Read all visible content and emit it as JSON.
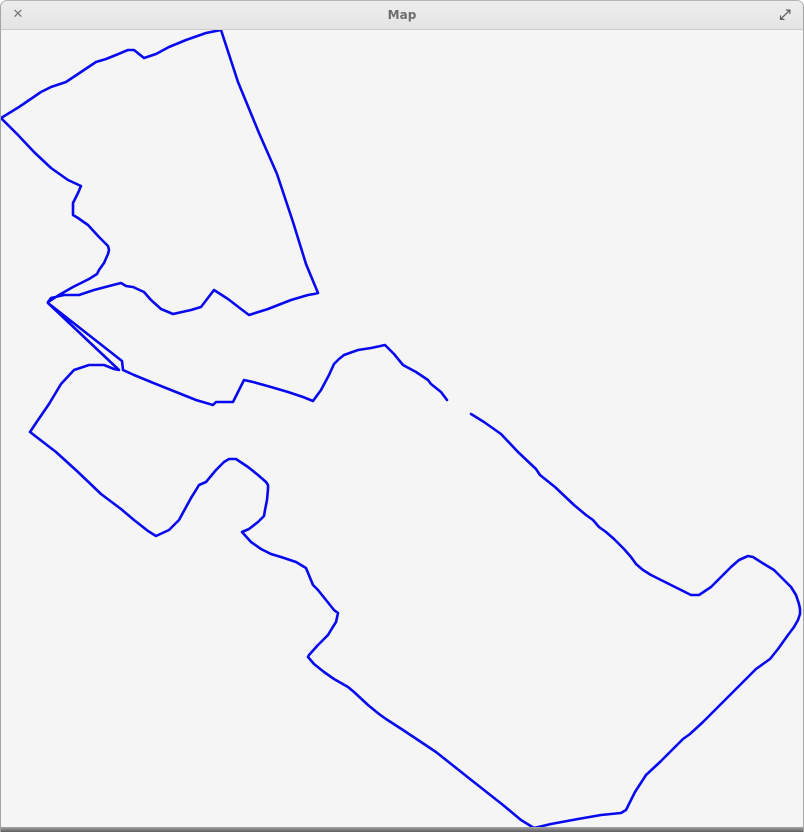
{
  "window": {
    "title": "Map",
    "close_icon": "✕",
    "expand_icon": "⤢"
  },
  "colors": {
    "titlebar_bg": "#e9e9e9",
    "titlebar_border": "#cdcdcd",
    "title_text": "#6d6d6d",
    "window_border": "#a5a5a5",
    "canvas_bg": "#f5f5f5",
    "bottom_bar": "#5e5e5e",
    "trace": "#0909ee"
  },
  "map": {
    "viewbox": "0 28 804 799",
    "stroke_color": "#0909ee",
    "stroke_width": 2.6,
    "paths": [
      {
        "name": "upper-boundary-trace",
        "closed": true,
        "points": "220,28 237,80 258,131 276,172 292,220 305,262 317,291 313,292 307,293 290,298 267,307 248,313 240,307 227,297 213,288 200,305 190,308 172,312 160,307 150,298 143,290 132,285 125,284 120,281 112,283 93,288 78,293 63,293 50,296 47,300 58,293 72,285 88,277 96,272 98,268 103,261 107,252 108,248 107,244 98,235 87,223 77,216 72,213 72,201 77,191 80,184 67,178 50,166 33,150 17,133 0,116 18,105 40,90 50,85 65,80 83,68 95,60 105,57 115,53 127,48 133,48 143,56 155,52 168,45 185,38 205,31"
      },
      {
        "name": "lower-loop-trace",
        "closed": false,
        "points": "470,412 483,420 500,432 517,450 535,467 539,473 554,485 573,503 585,513 592,518 598,525 605,530 613,537 618,542 623,547 630,555 635,562 642,568 650,573 660,578 670,583 680,588 690,593 698,593 710,585 720,575 730,565 738,558 747,554 752,555 763,562 773,568 782,577 790,585 795,593 798,602 799,607 799,612 797,618 793,625 787,633 777,647 769,657 755,667 745,677 735,687 722,700 712,710 702,720 689,732 682,737 672,747 659,760 645,773 634,790 625,808 620,811 600,813 577,817 550,822 533,826 520,818 502,803 469,777 435,750 402,728 385,717 378,712 367,703 353,690 347,685 333,677 323,670 313,662 307,655 308,653 317,643 322,638 327,633 330,628 335,620 337,611 333,608 325,598 317,588 312,583 305,566 295,560 280,555 270,552 260,547 250,540 241,530 248,527 257,520 263,514 264,508 266,498 267,487 267,483 265,480 257,473 247,465 235,457 228,457 223,460 215,468 205,480 198,483 195,488 190,496 178,518 168,528 155,534 147,529 133,518 120,507 100,492 77,470 55,450 29,430 35,421 48,402 60,382 73,368 88,363 103,363 113,367 118,368 47,301 121,359 122,368 133,373 150,380 170,388 195,398 212,403 215,400 232,400 243,378 252,380 270,385 287,390 302,395 312,399 320,388 328,373 333,362 338,357 343,353 357,348 370,346 384,343 393,352 402,363 415,370 427,378 430,382 440,390 446,398"
      }
    ]
  }
}
